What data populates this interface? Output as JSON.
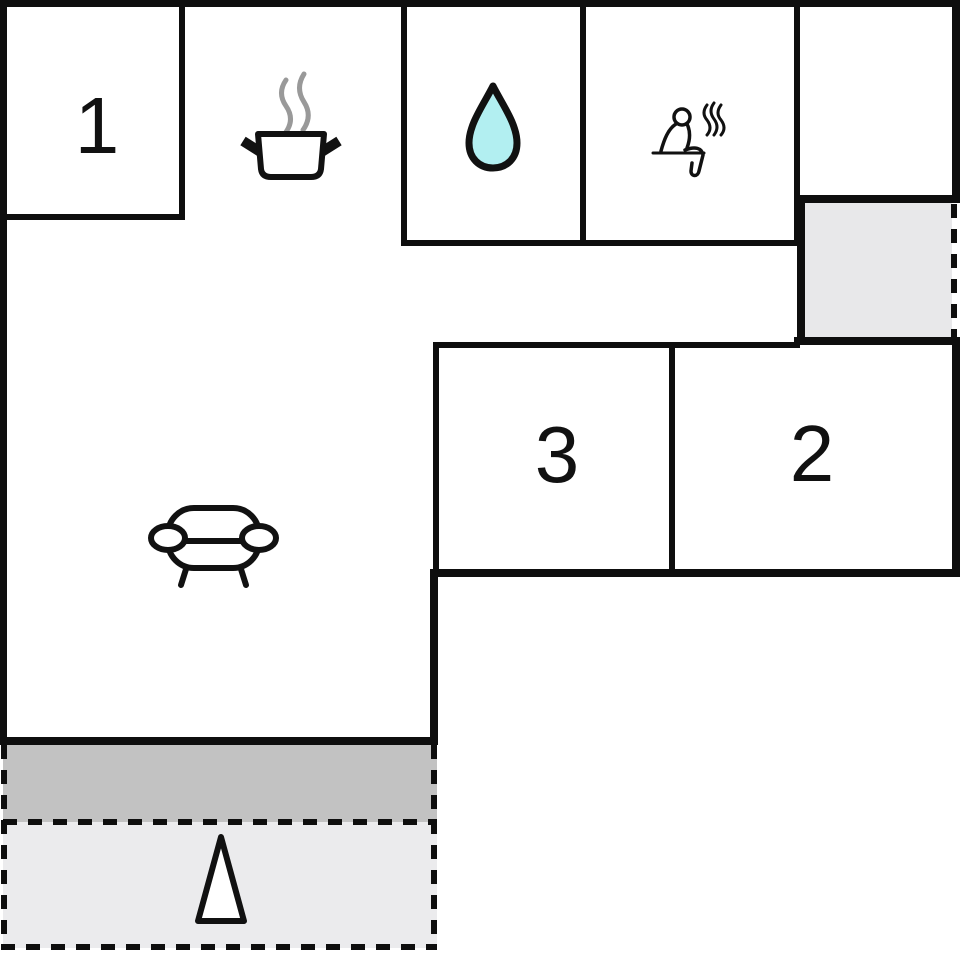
{
  "plan": {
    "title": "floor-plan",
    "rooms": [
      {
        "name": "bedroom-1",
        "label": "1"
      },
      {
        "name": "bedroom-2",
        "label": "2"
      },
      {
        "name": "bedroom-3",
        "label": "3"
      },
      {
        "name": "kitchen",
        "icon": "cooking-pot-icon"
      },
      {
        "name": "bathroom",
        "icon": "water-drop-icon"
      },
      {
        "name": "sauna",
        "icon": "sauna-person-icon"
      },
      {
        "name": "living-room",
        "icon": "sofa-icon"
      },
      {
        "name": "annex",
        "icon": ""
      },
      {
        "name": "terrace",
        "icon": "north-arrow-icon"
      }
    ],
    "colors": {
      "wall": "#0e0e0e",
      "water_drop_fill": "#b2eff1",
      "steam_gray": "#999999",
      "annex_fill": "#e8e8ea",
      "terrace_dark": "#c2c2c2",
      "terrace_light": "#ebebed",
      "icon_stroke": "#111111",
      "icon_fill": "#ffffff"
    }
  }
}
